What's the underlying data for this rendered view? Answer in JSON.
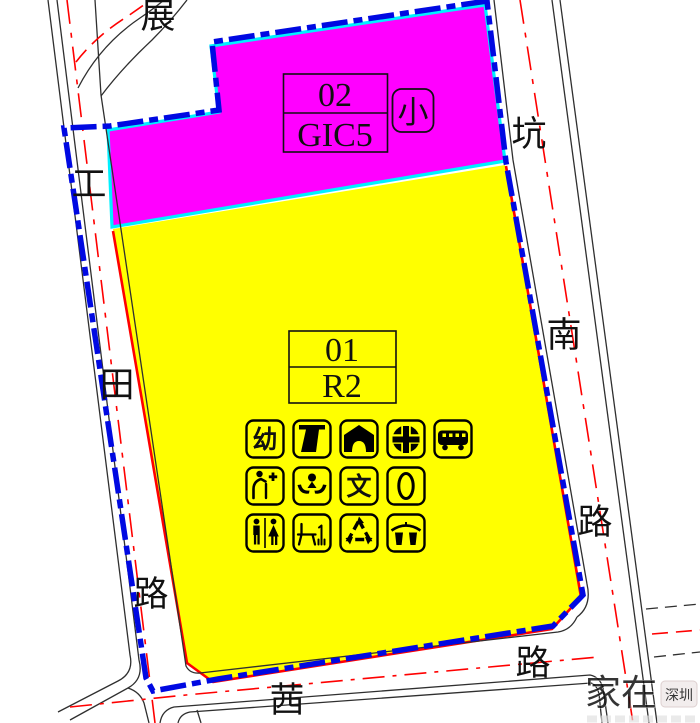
{
  "colors": {
    "residential_fill": "#FFFF00",
    "gic_fill": "#FF00FF",
    "parcel_outline_red": "#FF0000",
    "gic_outline_cyan": "#00F0FF",
    "boundary_blue": "#0009E2",
    "road_centerline_red": "#FF0000",
    "road_line_black": "#2f2f2f"
  },
  "parcels": {
    "gic5": {
      "code": "02",
      "use_code": "GIC5",
      "school_tag": "小"
    },
    "r2": {
      "code": "01",
      "use_code": "R2"
    }
  },
  "roads": {
    "top_label": "展",
    "left_labels": [
      "工",
      "田",
      "路"
    ],
    "right_labels": [
      "坑",
      "南",
      "路"
    ],
    "bottom_labels": [
      "茜",
      "路"
    ]
  },
  "facility_icons": {
    "kindergarten_char": "幼",
    "culture_char": "文",
    "names_row1": [
      "kindergarten",
      "refuse-collection-point",
      "community-house",
      "clinic",
      "bus-terminus"
    ],
    "names_row2": [
      "elderly-care",
      "childcare-welfare",
      "cultural-activity-room",
      "sports-ground"
    ],
    "names_row3": [
      "public-toilet",
      "sanitation-rest-station",
      "recycling-point",
      "covered-market"
    ]
  },
  "watermark": {
    "brand": "家在",
    "badge": "深圳"
  }
}
